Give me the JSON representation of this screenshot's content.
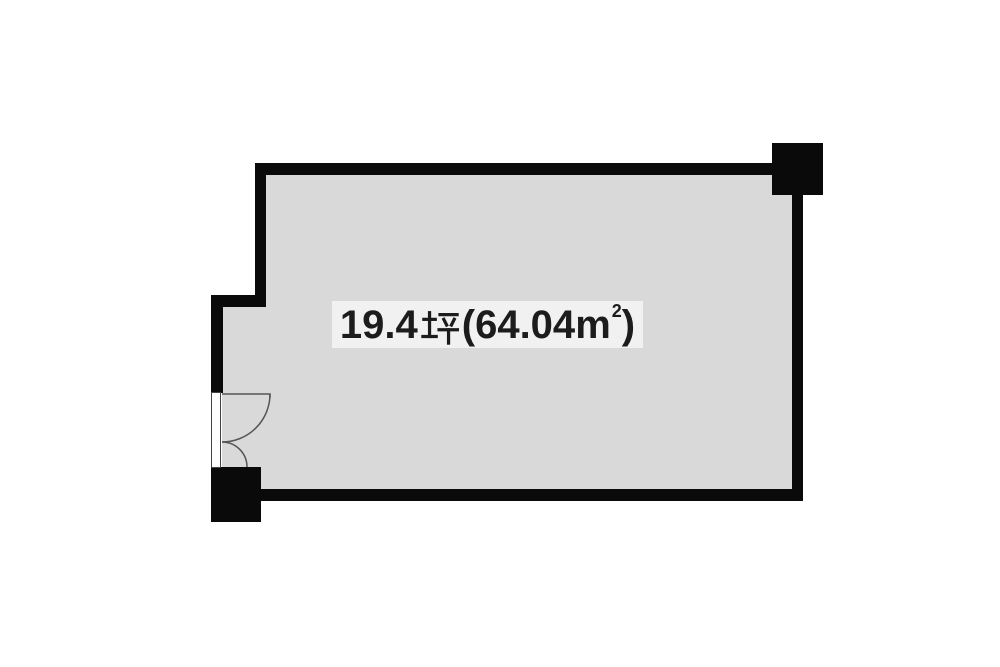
{
  "canvas": {
    "background_color": "#ffffff"
  },
  "floor_plan": {
    "area_label": {
      "full_text": "19.4坪(64.04㎡)",
      "tsubo_value": "19.4",
      "tsubo_unit": "坪",
      "open_paren": "(",
      "sqm_value": "64.04",
      "sqm_unit_base": "m",
      "sqm_unit_exponent": "2",
      "close_paren": ")",
      "background_color": "#f1f1f1",
      "text_color": "#1c1c1c"
    },
    "colors": {
      "room_fill": "#d9d9d9",
      "wall": "#0a0a0a",
      "door_line": "#555555",
      "door_frame_fill": "#ffffff",
      "label_background": "#f1f1f1"
    }
  }
}
